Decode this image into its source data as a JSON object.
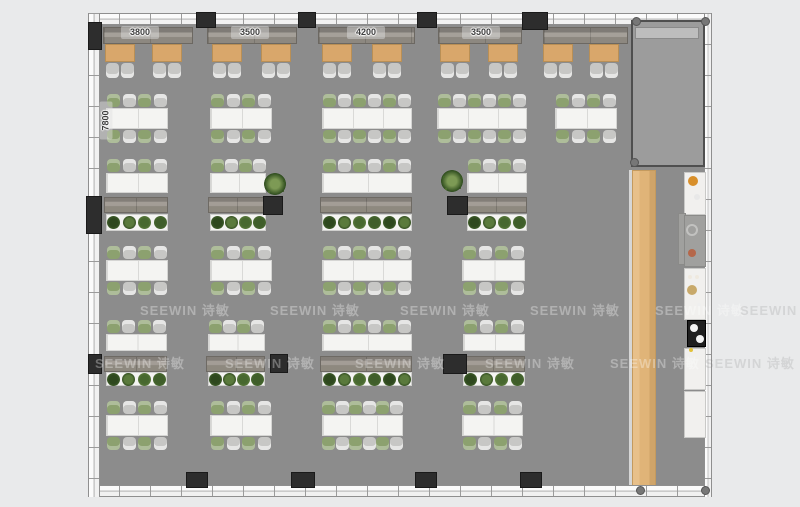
{
  "watermark": {
    "text": "SEEWIN 诗敏",
    "positions": [
      {
        "x": 140,
        "y": 300,
        "outside": false
      },
      {
        "x": 270,
        "y": 300,
        "outside": false
      },
      {
        "x": 400,
        "y": 300,
        "outside": false
      },
      {
        "x": 530,
        "y": 300,
        "outside": false
      },
      {
        "x": 655,
        "y": 300,
        "outside": false
      },
      {
        "x": 740,
        "y": 300,
        "outside": true
      },
      {
        "x": 95,
        "y": 353,
        "outside": false
      },
      {
        "x": 225,
        "y": 353,
        "outside": false
      },
      {
        "x": 355,
        "y": 353,
        "outside": false
      },
      {
        "x": 485,
        "y": 353,
        "outside": false
      },
      {
        "x": 610,
        "y": 353,
        "outside": false
      },
      {
        "x": 705,
        "y": 353,
        "outside": true
      }
    ]
  },
  "dimensions": {
    "horizontal": [
      {
        "text": "3800",
        "cx": 140,
        "cy": 33
      },
      {
        "text": "3500",
        "cx": 250,
        "cy": 33
      },
      {
        "text": "4200",
        "cx": 366,
        "cy": 33
      },
      {
        "text": "3500",
        "cx": 481,
        "cy": 33
      }
    ],
    "vertical": {
      "text": "7800",
      "cx": 106,
      "cy": 121
    }
  },
  "colors": {
    "background": "#e9eaeb",
    "floor": "#8c8c8c",
    "meetingFloor": "#9c9c9c",
    "boothTable": "#d9a76b",
    "chairGreen": "#8ca16f",
    "chairGray": "#c7c7c5",
    "tableWhite": "#f4f4f2",
    "barWood": "#e0b478",
    "pillar": "#2d2d2d",
    "plantGreens": [
      "#3f5e2a",
      "#2e481e",
      "#5a7a3c",
      "#47682f"
    ]
  },
  "layout": {
    "floor": {
      "x": 100,
      "y": 24,
      "w": 606,
      "h": 463
    },
    "walls": {
      "top": {
        "x": 88,
        "y": 13,
        "w": 624,
        "h": 12
      },
      "bottom": {
        "x": 88,
        "y": 485,
        "w": 624,
        "h": 12
      },
      "left": {
        "x": 88,
        "y": 13,
        "w": 12,
        "h": 484
      },
      "right": {
        "x": 704,
        "y": 13,
        "w": 8,
        "h": 484
      }
    },
    "meetingRoom": {
      "x": 631,
      "y": 20,
      "w": 74,
      "h": 147,
      "cabinet": {
        "x": 635,
        "y": 27,
        "w": 64,
        "h": 12
      }
    },
    "barCounter": {
      "x": 632,
      "y": 170,
      "w": 24,
      "h": 317
    },
    "barEdge": {
      "x": 629,
      "y": 170,
      "w": 3,
      "h": 317
    },
    "boothBenches": [
      {
        "x": 103,
        "y": 27,
        "w": 90,
        "h": 17
      },
      {
        "x": 207,
        "y": 27,
        "w": 90,
        "h": 17
      },
      {
        "x": 318,
        "y": 27,
        "w": 97,
        "h": 17
      },
      {
        "x": 438,
        "y": 27,
        "w": 84,
        "h": 17
      },
      {
        "x": 543,
        "y": 27,
        "w": 85,
        "h": 17
      }
    ],
    "boothTables": {
      "y": 44,
      "w": 30,
      "h": 18,
      "chairY": 63,
      "xs": [
        105,
        152,
        212,
        261,
        322,
        372,
        440,
        488,
        543,
        589
      ]
    },
    "tableRows": [
      {
        "chairTopY": 94,
        "tableY": 108,
        "tableH": 21,
        "chairBotY": 130,
        "tables": [
          {
            "x": 106,
            "w": 62,
            "seats": 4,
            "mod": 2
          },
          {
            "x": 210,
            "w": 62,
            "seats": 4,
            "mod": 2
          },
          {
            "x": 322,
            "w": 90,
            "seats": 6,
            "mod": 3
          },
          {
            "x": 437,
            "w": 90,
            "seats": 6,
            "mod": 3
          },
          {
            "x": 555,
            "w": 62,
            "seats": 4,
            "mod": 2
          }
        ]
      },
      {
        "chairTopY": 246,
        "tableY": 260,
        "tableH": 21,
        "chairBotY": 282,
        "tables": [
          {
            "x": 106,
            "w": 62,
            "seats": 4,
            "mod": 2
          },
          {
            "x": 210,
            "w": 62,
            "seats": 4,
            "mod": 2
          },
          {
            "x": 322,
            "w": 90,
            "seats": 6,
            "mod": 3
          },
          {
            "x": 462,
            "w": 63,
            "seats": 4,
            "mod": 2
          }
        ]
      },
      {
        "chairTopY": 401,
        "tableY": 415,
        "tableH": 21,
        "chairBotY": 437,
        "tables": [
          {
            "x": 106,
            "w": 62,
            "seats": 4,
            "mod": 2
          },
          {
            "x": 210,
            "w": 62,
            "seats": 4,
            "mod": 2
          },
          {
            "x": 322,
            "w": 81,
            "seats": 6,
            "mod": 3
          },
          {
            "x": 462,
            "w": 61,
            "seats": 4,
            "mod": 2
          }
        ]
      }
    ],
    "divingRows": [
      {
        "chairY": 159,
        "tableY": 173,
        "tableH": 20,
        "benchY": 197,
        "benchH": 16,
        "planterY": 214,
        "planterH": 17,
        "groups": [
          {
            "x": 106,
            "w": 62,
            "seats": 4,
            "plants": 4
          },
          {
            "x": 210,
            "w": 56,
            "seats": 4,
            "plants": 4
          },
          {
            "x": 322,
            "w": 90,
            "seats": 6,
            "plants": 6
          },
          {
            "x": 467,
            "w": 60,
            "seats": 4,
            "plants": 4
          }
        ]
      },
      {
        "chairY": 320,
        "tableY": 334,
        "tableH": 17,
        "benchY": 356,
        "benchH": 16,
        "planterY": 372,
        "planterH": 14,
        "groups": [
          {
            "x": 106,
            "w": 61,
            "seats": 4,
            "plants": 4
          },
          {
            "x": 208,
            "w": 57,
            "seats": 4,
            "plants": 4
          },
          {
            "x": 322,
            "w": 90,
            "seats": 6,
            "plants": 6
          },
          {
            "x": 463,
            "w": 62,
            "seats": 4,
            "plants": 4
          }
        ]
      }
    ],
    "pillars": [
      {
        "x": 196,
        "y": 12,
        "w": 20,
        "h": 16
      },
      {
        "x": 298,
        "y": 12,
        "w": 18,
        "h": 16
      },
      {
        "x": 417,
        "y": 12,
        "w": 20,
        "h": 16
      },
      {
        "x": 522,
        "y": 12,
        "w": 26,
        "h": 18
      },
      {
        "x": 88,
        "y": 22,
        "w": 14,
        "h": 28
      },
      {
        "x": 86,
        "y": 196,
        "w": 16,
        "h": 38
      },
      {
        "x": 263,
        "y": 196,
        "w": 20,
        "h": 19
      },
      {
        "x": 447,
        "y": 196,
        "w": 21,
        "h": 19
      },
      {
        "x": 88,
        "y": 354,
        "w": 14,
        "h": 20
      },
      {
        "x": 270,
        "y": 354,
        "w": 18,
        "h": 19
      },
      {
        "x": 443,
        "y": 354,
        "w": 24,
        "h": 20
      },
      {
        "x": 186,
        "y": 472,
        "w": 22,
        "h": 16
      },
      {
        "x": 291,
        "y": 472,
        "w": 24,
        "h": 16
      },
      {
        "x": 415,
        "y": 472,
        "w": 22,
        "h": 16
      },
      {
        "x": 520,
        "y": 472,
        "w": 22,
        "h": 16
      }
    ],
    "cornerDots": [
      {
        "x": 632,
        "y": 17
      },
      {
        "x": 701,
        "y": 17
      },
      {
        "x": 630,
        "y": 158
      },
      {
        "x": 636,
        "y": 486
      },
      {
        "x": 701,
        "y": 486
      }
    ],
    "pottedPlants": [
      {
        "x": 264,
        "y": 173
      },
      {
        "x": 441,
        "y": 170
      }
    ],
    "counters": [
      {
        "x": 684,
        "y": 172,
        "w": 22,
        "h": 43,
        "type": "white"
      },
      {
        "x": 678,
        "y": 213,
        "w": 8,
        "h": 52,
        "type": "gray"
      },
      {
        "x": 684,
        "y": 215,
        "w": 22,
        "h": 52,
        "type": "gray"
      },
      {
        "x": 684,
        "y": 268,
        "w": 22,
        "h": 52,
        "type": "white"
      },
      {
        "x": 687,
        "y": 320,
        "w": 19,
        "h": 27,
        "type": "black"
      },
      {
        "x": 684,
        "y": 348,
        "w": 22,
        "h": 42,
        "type": "white"
      },
      {
        "x": 684,
        "y": 391,
        "w": 22,
        "h": 47,
        "type": "white"
      }
    ],
    "fixtures": [
      {
        "x": 693,
        "y": 181,
        "r": 5,
        "color": "#d88f2a",
        "ring": false
      },
      {
        "x": 697,
        "y": 197,
        "r": 3,
        "color": "#e8e8e8",
        "ring": false
      },
      {
        "x": 692,
        "y": 230,
        "r": 6,
        "color": "#c2c2c0",
        "ring": true
      },
      {
        "x": 692,
        "y": 253,
        "r": 4,
        "color": "#b5674a",
        "ring": false
      },
      {
        "x": 690,
        "y": 277,
        "r": 2,
        "color": "#efe9df",
        "ring": false
      },
      {
        "x": 697,
        "y": 277,
        "r": 2,
        "color": "#efe9df",
        "ring": false
      },
      {
        "x": 692,
        "y": 290,
        "r": 5,
        "color": "#c8a96a",
        "ring": false
      },
      {
        "x": 699,
        "y": 305,
        "r": 2,
        "color": "#efefef",
        "ring": false
      },
      {
        "x": 694,
        "y": 328,
        "r": 4,
        "color": "#f2f2f2",
        "ring": false
      },
      {
        "x": 700,
        "y": 339,
        "r": 4,
        "color": "#f2f2f2",
        "ring": false
      },
      {
        "x": 691,
        "y": 350,
        "r": 2,
        "color": "#e2c23a",
        "ring": false
      }
    ]
  }
}
